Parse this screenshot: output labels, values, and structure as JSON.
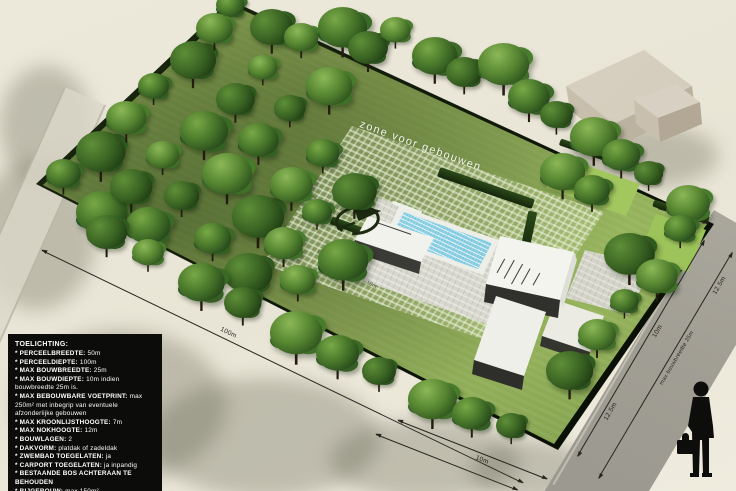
{
  "legend": {
    "title": "TOELICHTING:",
    "bullet": "*",
    "items": [
      {
        "label": "PERCEELBREEDTE:",
        "value": "50m"
      },
      {
        "label": "PERCEELDIEPTE:",
        "value": "100m"
      },
      {
        "label": "MAX BOUWBREEDTE:",
        "value": "25m"
      },
      {
        "label": "MAX BOUWDIEPTE:",
        "value": "10m indien bouwbreedte 25m is."
      },
      {
        "label": "MAX BEBOUWBARE VOETPRINT:",
        "value": "max 250m² met inbegrip van eventuele afzonderlijke gebouwen"
      },
      {
        "label": "MAX KROONLIJSTHOOGTE:",
        "value": "7m"
      },
      {
        "label": "MAX NOKHOOGTE:",
        "value": "12m"
      },
      {
        "label": "BOUWLAGEN:",
        "value": "2"
      },
      {
        "label": "DAKVORM:",
        "value": "platdak of zadeldak"
      },
      {
        "label": "ZWEMBAD TOEGELATEN:",
        "value": "ja"
      },
      {
        "label": "CARPORT TOEGELATEN:",
        "value": "ja inpandig"
      },
      {
        "label": "BESTAANDE BOS ACHTERAAN TE BEHOUDEN",
        "value": ""
      },
      {
        "label": "BIJGEBOUW:",
        "value": "max 150m²"
      }
    ]
  },
  "plan": {
    "zone_label": "zone voor gebouwen",
    "road_name": "Essensteenweg",
    "dimensions": {
      "parcel_depth": "100m",
      "bottom_depth": "10m",
      "road_inner_upper": "10m",
      "road_inner_lower": "12.5m",
      "road_outer_upper": "12.5m",
      "road_buildwidth": "max bouwbreedte 25m",
      "zone_side": "12.5m",
      "zone_front": "10m"
    }
  },
  "colors": {
    "ground": "#eae6d8",
    "grass": "#8fae56",
    "hedge": "#14210c",
    "road": "#a3a097",
    "pool": "#9fd8e8",
    "building_white": "#f2f2ee",
    "building_dark": "#30302c",
    "neighbour_tan": "#cfc7b6",
    "legend_bg": "#0c0c0a",
    "dimension_line": "#26261f"
  }
}
